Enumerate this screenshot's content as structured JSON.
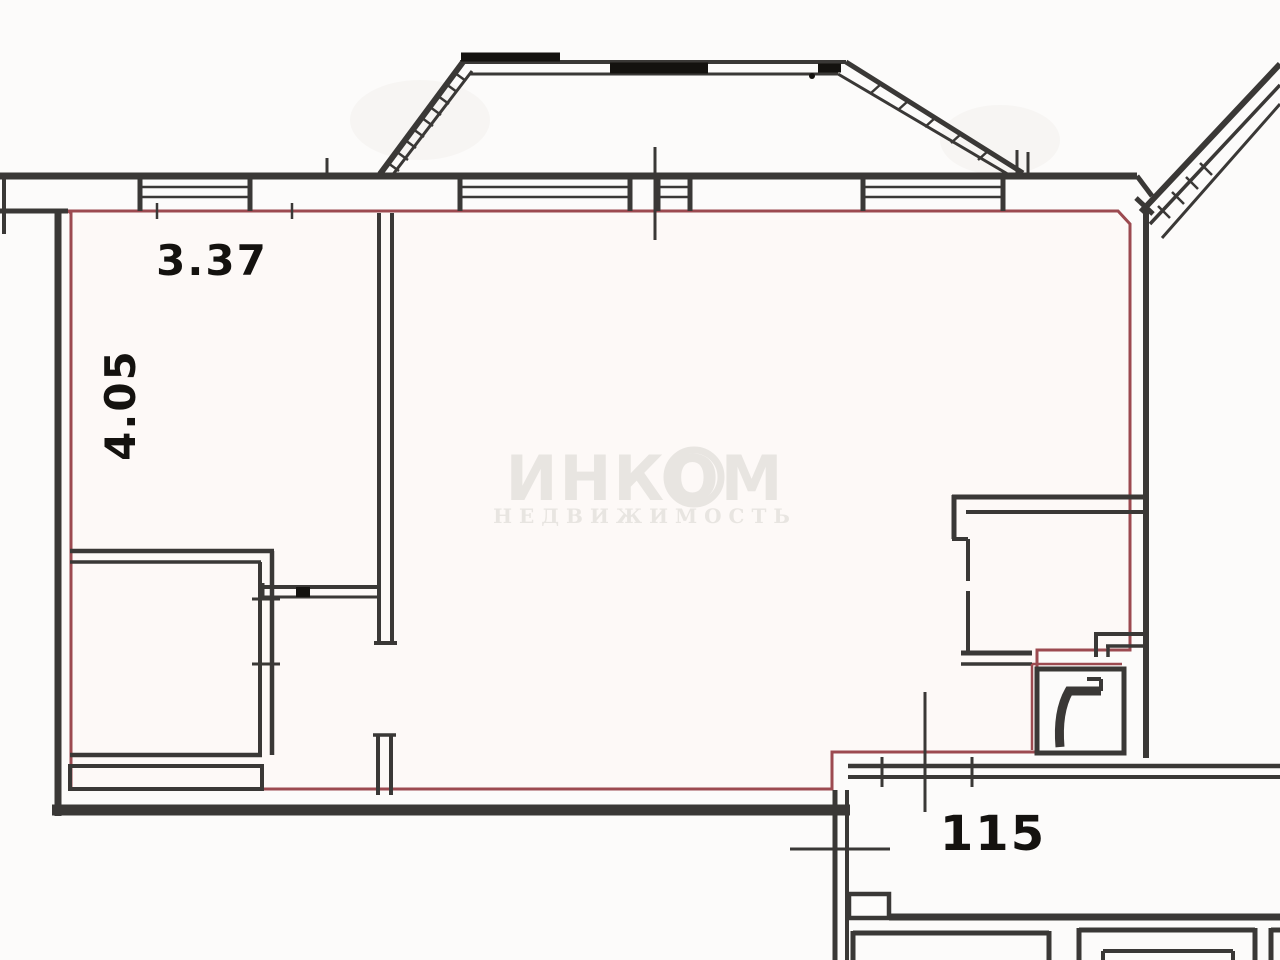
{
  "plan": {
    "room_dimensions": {
      "width_label": "3.37",
      "height_label": "4.05"
    },
    "landing_number": "115",
    "watermark": {
      "line1": "ИНКОМ",
      "line2": "НЕДВИЖИМОСТЬ"
    }
  },
  "colors": {
    "wall": "#3a3836",
    "ink": "#14120f",
    "boundary": "#9c4a50",
    "watermark": "#e8e5e1",
    "background": "#faf9f8",
    "paper": "#fcfbfa",
    "apartment_fill": "#fdf9f7"
  }
}
